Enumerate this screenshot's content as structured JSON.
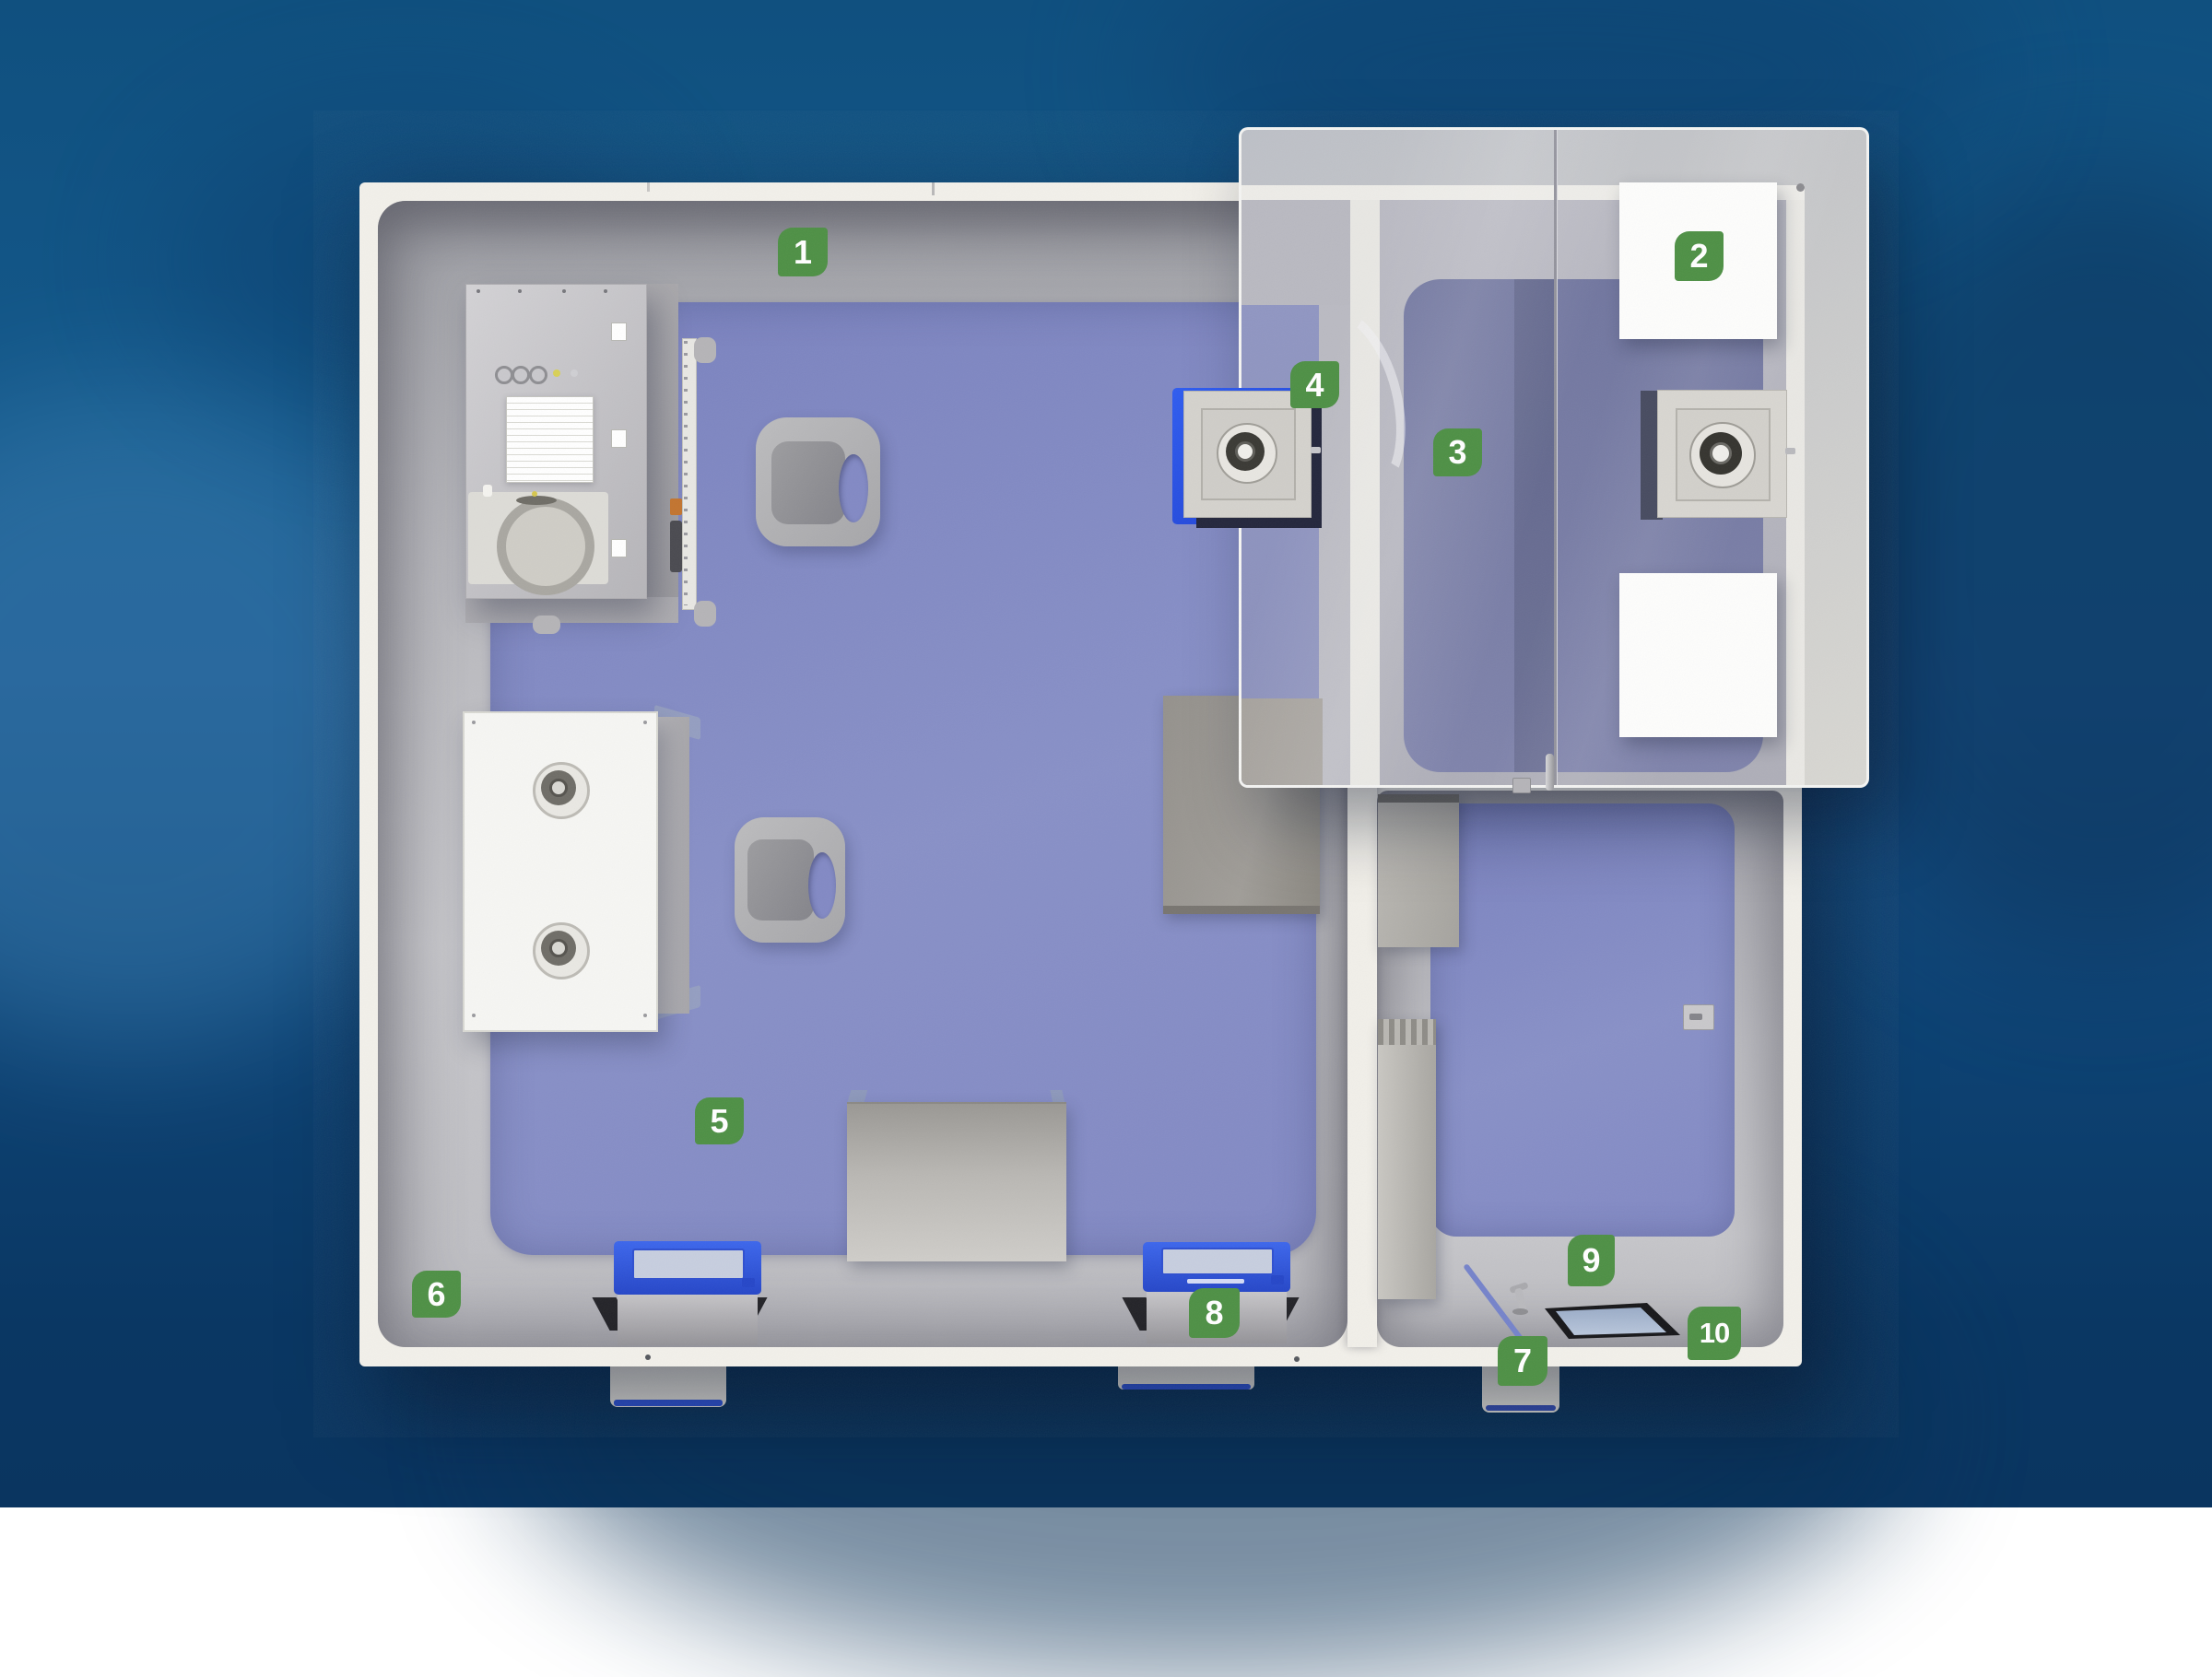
{
  "scene": {
    "description": "Top-down 3D cutaway render of a two-room modular cleanroom with a semi-transparent roof panel and numbered callout badges"
  },
  "colors": {
    "label_green": "#4e9045",
    "label_text": "#ffffff",
    "wall_white": "#f2f0ea",
    "floor_grey": "#b9b9be",
    "mat_blue": "#8289c4",
    "mat_blue_hazy": "#767b9e",
    "accent_blue": "#2f55dd",
    "glass_grey": "#c9cacb",
    "background_blue": "#12497d"
  },
  "callouts": [
    {
      "number": "1"
    },
    {
      "number": "2"
    },
    {
      "number": "3"
    },
    {
      "number": "4"
    },
    {
      "number": "5"
    },
    {
      "number": "6"
    },
    {
      "number": "7"
    },
    {
      "number": "8"
    },
    {
      "number": "9"
    },
    {
      "number": "10"
    }
  ]
}
